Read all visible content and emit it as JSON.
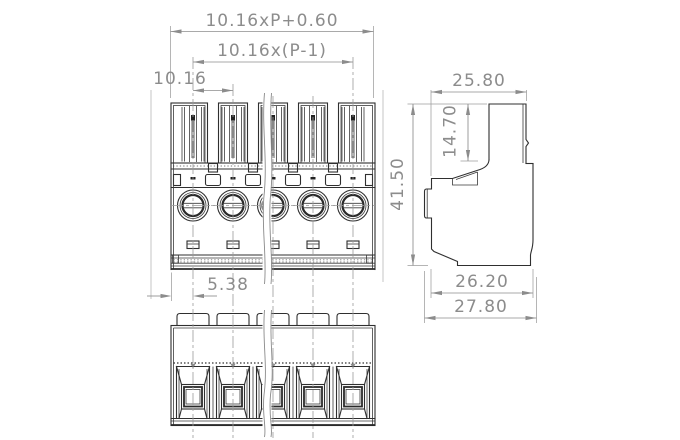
{
  "drawing": {
    "type": "terminal-block-connector-technical-drawing",
    "dimensions": {
      "overall_width": "10.16xP+0.60",
      "pole_span": "10.16x(P-1)",
      "pitch": "10.16",
      "edge_to_first_pole": "5.38",
      "side_top_width": "25.80",
      "plug_height": "14.70",
      "total_height": "41.50",
      "body_depth": "26.20",
      "overall_depth": "27.80"
    },
    "colors": {
      "outline": "#2f2f2f",
      "dimension": "#8c8c8c",
      "centerline": "#9b9b9b",
      "background": "#ffffff"
    }
  }
}
